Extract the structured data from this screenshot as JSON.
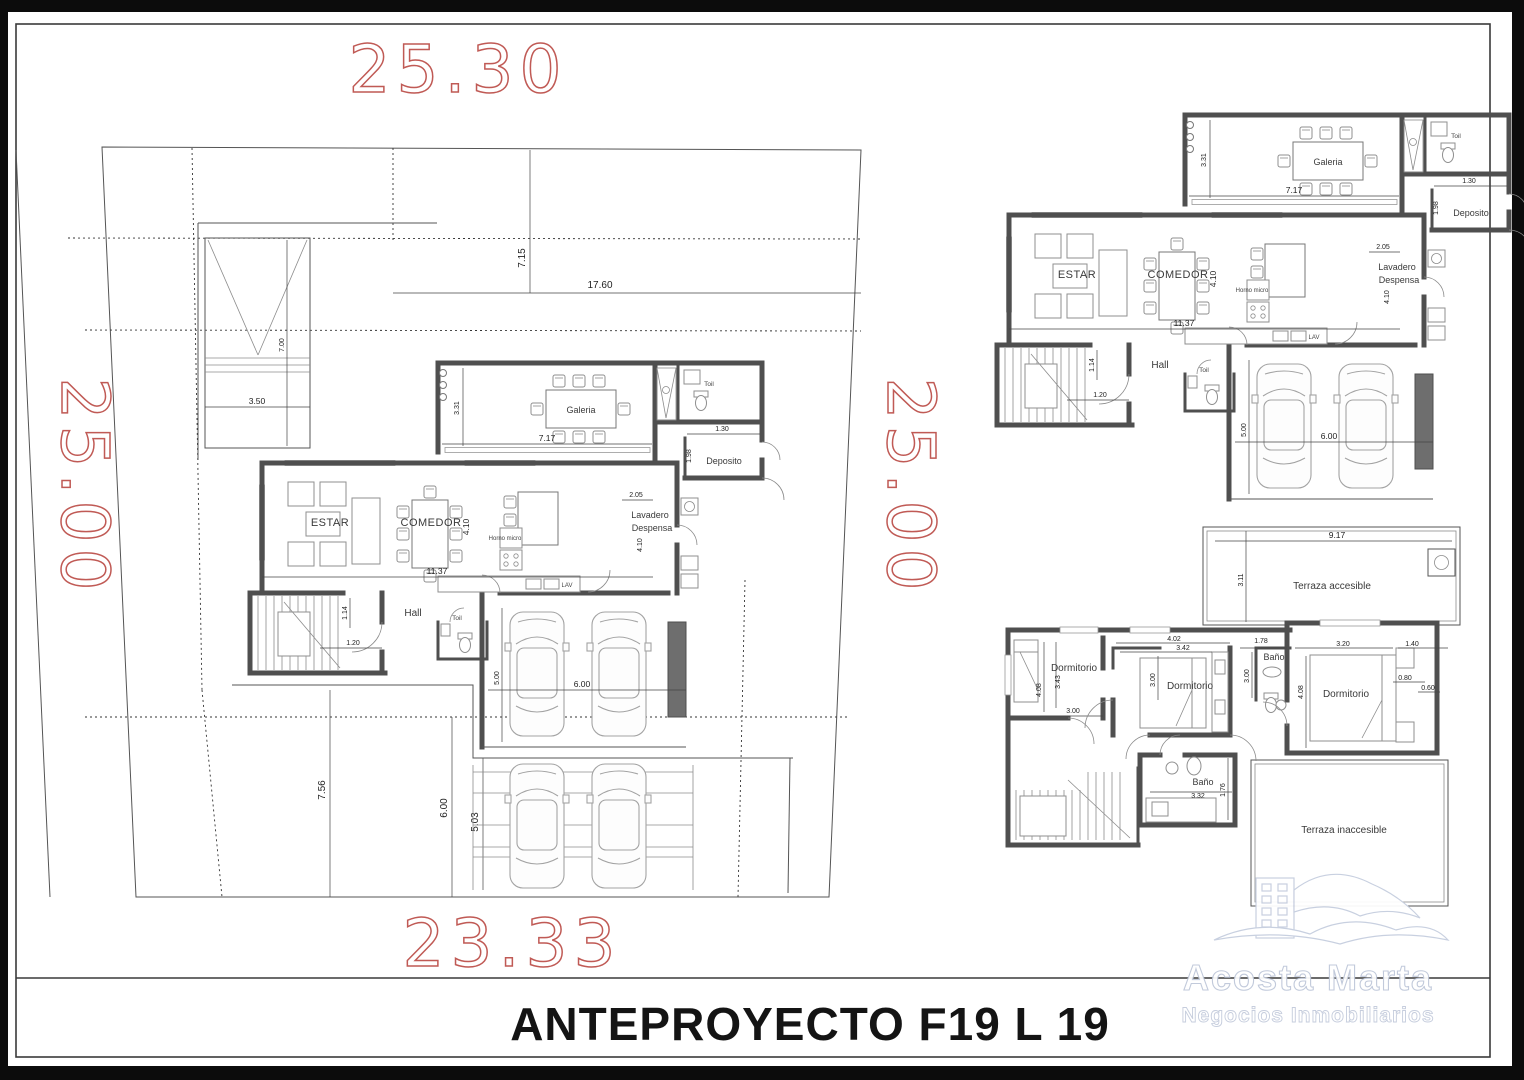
{
  "frame": {
    "title": "ANTEPROYECTO F19 L 19"
  },
  "site": {
    "dim_top": "25.30",
    "dim_left": "25.00",
    "dim_right": "25.00",
    "dim_bottom": "23.33",
    "dim_front_setback": "7.15",
    "dim_house_width": "17.60",
    "dim_ramp_len": "7.00",
    "dim_ramp_width": "3.50",
    "dim_back_yard": "7.56",
    "dim_drive_len": "6.00",
    "dim_drive_width": "5.03"
  },
  "ground_floor": {
    "rooms": {
      "galeria": "Galeria",
      "estar": "ESTAR",
      "comedor": "COMEDOR",
      "hall": "Hall",
      "deposito": "Deposito",
      "lavadero1": "Lavadero",
      "lavadero2": "Despensa",
      "toil_top": "Toil",
      "toil_hall": "Toil",
      "horno": "Horno micro",
      "lav": "LAV"
    },
    "dims": {
      "galeria_w": "7.17",
      "galeria_d": "3.31",
      "deposito_w": "1.30",
      "deposito_d": "1.98",
      "living_w": "11.37",
      "living_d": "4.10",
      "lavadero_w": "2.05",
      "lavadero_d": "4.10",
      "hall_w": "1.20",
      "hall_d": "1.14",
      "garage_w": "6.00",
      "garage_d": "5.00"
    }
  },
  "upper_floor": {
    "rooms": {
      "terraza_acc": "Terraza accesible",
      "terraza_inacc": "Terraza inaccesible",
      "dorm1": "Dormitorio",
      "dorm2": "Dormitorio",
      "dorm3": "Dormitorio",
      "bano1": "Baño",
      "bano2": "Baño"
    },
    "dims": {
      "terraza_w": "9.17",
      "terraza_d": "3.11",
      "dorm1_d": "4.08",
      "dorm1_bed": "3.43",
      "dorm1_w": "3.00",
      "dorm2_wall": "4.02",
      "dorm2_w": "3.42",
      "dorm2_d": "3.00",
      "closet_d": "3.00",
      "bano1_w": "1.78",
      "dorm3_w": "3.20",
      "dorm3_ext": "1.40",
      "dorm3_shelf": "0.80",
      "dorm3_edge": "0.60",
      "dorm3_d": "4.08",
      "bano2_w": "3.32",
      "bano2_d": "1.76"
    }
  },
  "logo": {
    "line1": "Acosta Marta",
    "line2": "Negocios Inmobiliarios"
  },
  "colors": {
    "red_dim": "#c05a55",
    "wall": "#4f4f4f",
    "paper": "#ffffff",
    "border": "#0c0c0c",
    "logo": "#c6cedf"
  }
}
